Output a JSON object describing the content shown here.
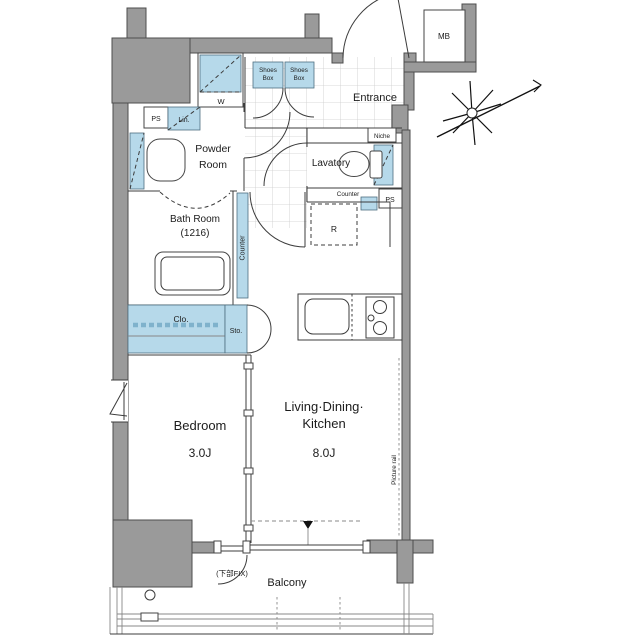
{
  "meta": {
    "type": "japanese-apartment-floor-plan"
  },
  "labels": {
    "ps_top": "PS",
    "lin": "Lin.",
    "w": "W",
    "powder_line1": "Powder",
    "powder_line2": "Room",
    "shoes1_line1": "Shoes",
    "shoes1_line2": "Box",
    "shoes2_line1": "Shoes",
    "shoes2_line2": "Box",
    "entrance": "Entrance",
    "mb": "MB",
    "niche": "Niche",
    "lavatory": "Lavatory",
    "counter_lavatory": "Counter",
    "ps_right": "PS",
    "bath_line1": "Bath Room",
    "bath_line2": "(1216)",
    "counter_hall": "Counter",
    "refrigerator": "R",
    "closet": "Clo.",
    "storage": "Sto.",
    "bedroom": "Bedroom",
    "bedroom_size": "3.0J",
    "ldk_line1": "Living·Dining·",
    "ldk_line2": "Kitchen",
    "ldk_size": "8.0J",
    "picture_rail": "Picture rail",
    "fix_note": "(下部FIX)",
    "balcony": "Balcony"
  },
  "colors": {
    "wall": "#9a9a9a",
    "wall_edge": "#4d4d4d",
    "fixture": "#b6d9ea",
    "line": "#3c3c3c",
    "tile": "#cccccc",
    "text": "#1c1c1c"
  }
}
